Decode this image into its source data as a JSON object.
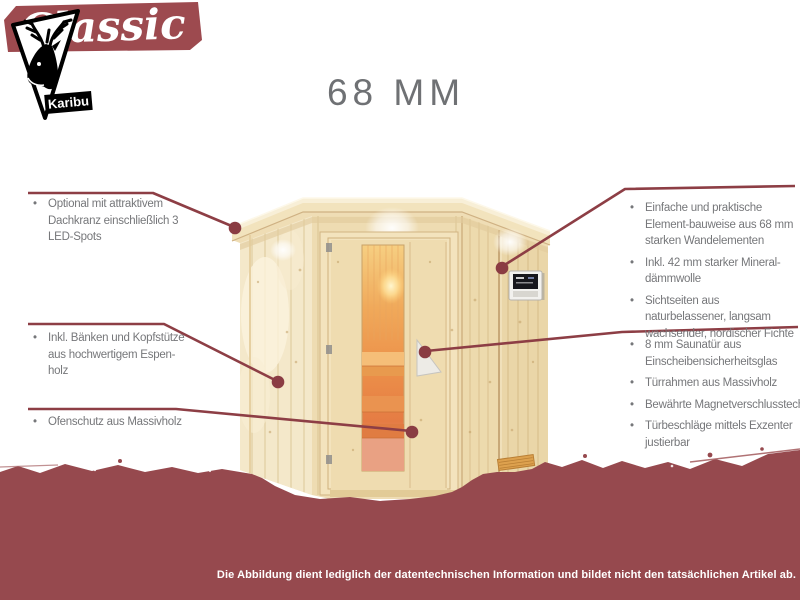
{
  "header": {
    "model_size": "68 MM",
    "model_name": "Classic"
  },
  "callouts": {
    "left": [
      {
        "text": "Optional mit attraktivem Dachkranz einschließlich 3 LED-Spots"
      },
      {
        "text": "Inkl. Bänken und Kopfstütze aus hochwertigem Espen-holz"
      },
      {
        "text": "Ofenschutz aus Massivholz"
      }
    ],
    "right_top": [
      {
        "text": "Einfache und praktische Element-bauweise aus 68 mm starken Wandelementen"
      },
      {
        "text": "Inkl. 42 mm starker Mineral-dämmwolle"
      },
      {
        "text": "Sichtseiten aus naturbelassener, langsam wachsender, nordischer Fichte"
      }
    ],
    "right_bottom": [
      {
        "text": "8 mm Saunatür aus Einscheibensicherheitsglas"
      },
      {
        "text": "Türrahmen aus Massivholz"
      },
      {
        "text": "Bewährte Magnetverschlusstechnik"
      },
      {
        "text": "Türbeschläge mittels Exzenter justierbar"
      }
    ],
    "bullet_char": "•"
  },
  "footer": {
    "disclaimer": "Die Abbildung dient lediglich der datentechnischen Information und bildet nicht den tatsächlichen Artikel ab."
  },
  "logo": {
    "brand": "Karibu"
  },
  "colors": {
    "banner_maroon": "#96494e",
    "ribbon_maroon": "#9d4a4f",
    "callout_line": "#8d3e45",
    "callout_dot": "#8a3c43",
    "text_gray": "#76777a",
    "title_gray": "#6f7174",
    "wood_light": "#efddb5",
    "glass_glow": "#ef9950"
  }
}
